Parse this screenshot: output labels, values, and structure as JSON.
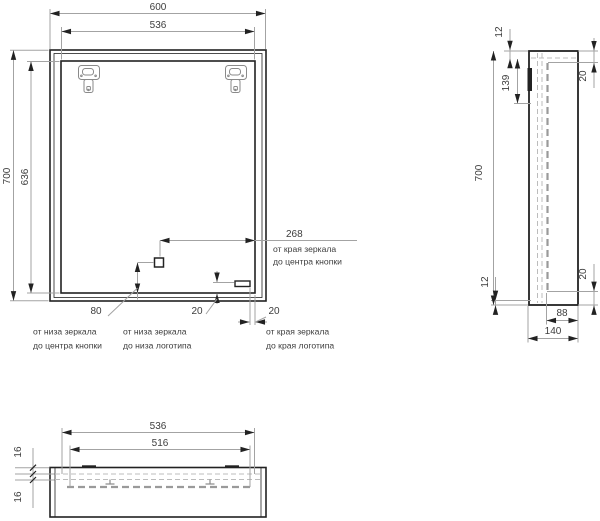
{
  "drawing": {
    "front_view": {
      "width_total": "600",
      "mirror_width": "536",
      "height_total": "700",
      "mirror_height": "636",
      "button_from_edge": "268",
      "button_from_edge_note_line1": "от края зеркала",
      "button_from_edge_note_line2": "до центра кнопки",
      "button_from_bottom": "80",
      "button_from_bottom_note_line1": "от низа зеркала",
      "button_from_bottom_note_line2": "до центра кнопки",
      "logo_from_bottom": "20",
      "logo_from_bottom_note_line1": "от низа зеркала",
      "logo_from_bottom_note_line2": "до низа логотипа",
      "logo_from_edge": "20",
      "logo_from_edge_note_line1": "от края зеркала",
      "logo_from_edge_note_line2": "до края логотипа"
    },
    "side_view": {
      "height_total": "700",
      "top_inset": "12",
      "bracket_offset": "139",
      "front_inset_top": "20",
      "bottom_inset": "12",
      "front_inset_bottom": "20",
      "inner_depth": "88",
      "depth_total": "140"
    },
    "bottom_view": {
      "mirror_width": "536",
      "inner_width": "516",
      "layer_offset_first": "16",
      "layer_offset_second": "16"
    }
  }
}
